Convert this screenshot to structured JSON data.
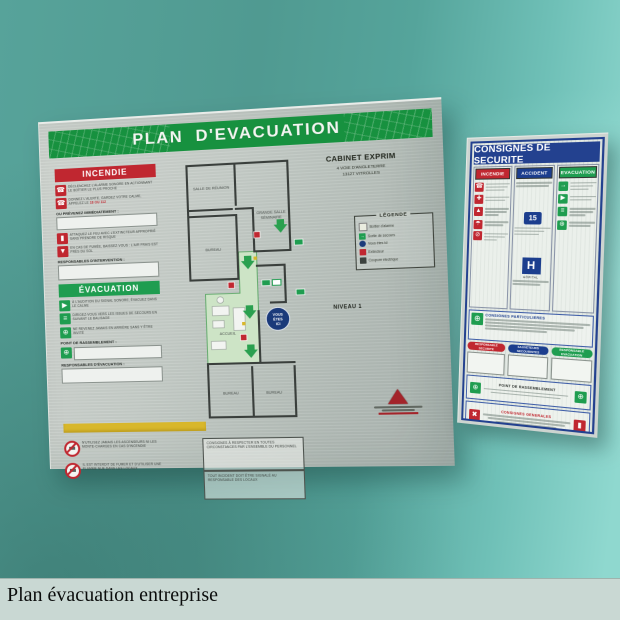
{
  "caption": "Plan évacuation entreprise",
  "left_sign": {
    "title": "PLAN D'EVACUATION",
    "incendie": {
      "title": "INCENDIE",
      "item1": "Déclenchez l'alarme sonore en actionnant le boîtier le plus proche",
      "item2": "Donnez l'alerte, gardez votre calme, appelez le",
      "numbers": "18 ou 112",
      "prevenez_label": "OU PRÉVENEZ IMMÉDIATEMENT :",
      "item3": "Attaquez le feu avec l'extincteur approprié sans prendre de risque",
      "item4": "En cas de fumée, baissez-vous : l'air frais est près du sol",
      "responsables_label": "RESPONSABLES D'INTERVENTION :"
    },
    "evacuation": {
      "title": "ÉVACUATION",
      "item1": "À l'audition du signal sonore, évacuez dans le calme",
      "item2": "Dirigez-vous vers les issues de secours en suivant le balisage",
      "item3": "Ne revenez jamais en arrière sans y être invité",
      "point_label": "POINT DE RASSEMBLEMENT :",
      "responsables_label": "RESPONSABLES D'ÉVACUATION :"
    },
    "notice1": "N'utilisez jamais les ascenseurs ni les monte-charges en cas d'incendie",
    "notice2": "Il est interdit de fumer et d'utiliser une flamme nue dans les locaux",
    "notice_box1": "Consignes à respecter en toutes circonstances par l'ensemble du personnel",
    "notice_box2": "Tout incident doit être signalé au responsable des locaux",
    "address": {
      "line1": "CABINET EXPRIM",
      "line2": "4 VOIE D'ANGLETERRE",
      "line3": "13127 VITROLLES"
    },
    "legend": {
      "title": "LÉGENDE",
      "items": [
        {
          "label": "Boîtier d'alarme"
        },
        {
          "label": "Sortie de secours"
        },
        {
          "label": "Vous êtes ici"
        },
        {
          "label": "Extincteur"
        },
        {
          "label": "Coupure électrique"
        }
      ]
    },
    "level": "NIVEAU 1",
    "plan": {
      "room_reunion": "SALLE DE RÉUNION",
      "room_seminaire1": "GRANDE SALLE",
      "room_seminaire2": "SÉMINAIRE",
      "room_bureau1": "BUREAU",
      "room_accueil": "ACCUEIL",
      "room_bureau2": "BUREAU",
      "room_bureau3": "BUREAU",
      "you_are_here1": "VOUS",
      "you_are_here2": "ÊTES",
      "you_are_here3": "ICI"
    }
  },
  "right_sign": {
    "title": "CONSIGNES DE SECURITE",
    "col_incendie": "INCENDIE",
    "col_accident": "ACCIDENT",
    "col_evacuation": "EVACUATION",
    "samu_number": "15",
    "hospital_letter": "H",
    "hospital_label": "HÔPITAL",
    "middle_title": "CONSIGNES PARTICULIERES",
    "pill1": "RESPONSABLE SECURITE",
    "pill2": "SAUVETEURS SECOURISTES",
    "pill3": "RESPONSABLE EVACUATION",
    "assembly_label": "POINT DE RASSEMBLEMENT",
    "general_label": "CONSIGNES GENERALES"
  },
  "colors": {
    "wall": "#509a91",
    "wall_light": "#8fd8cf",
    "caption_bg": "#c9d8d3",
    "green": "#17913f",
    "red": "#c02730",
    "blue": "#23418f",
    "yellow": "#d8b72b",
    "you_are_here_blue": "#1b3a7a"
  }
}
